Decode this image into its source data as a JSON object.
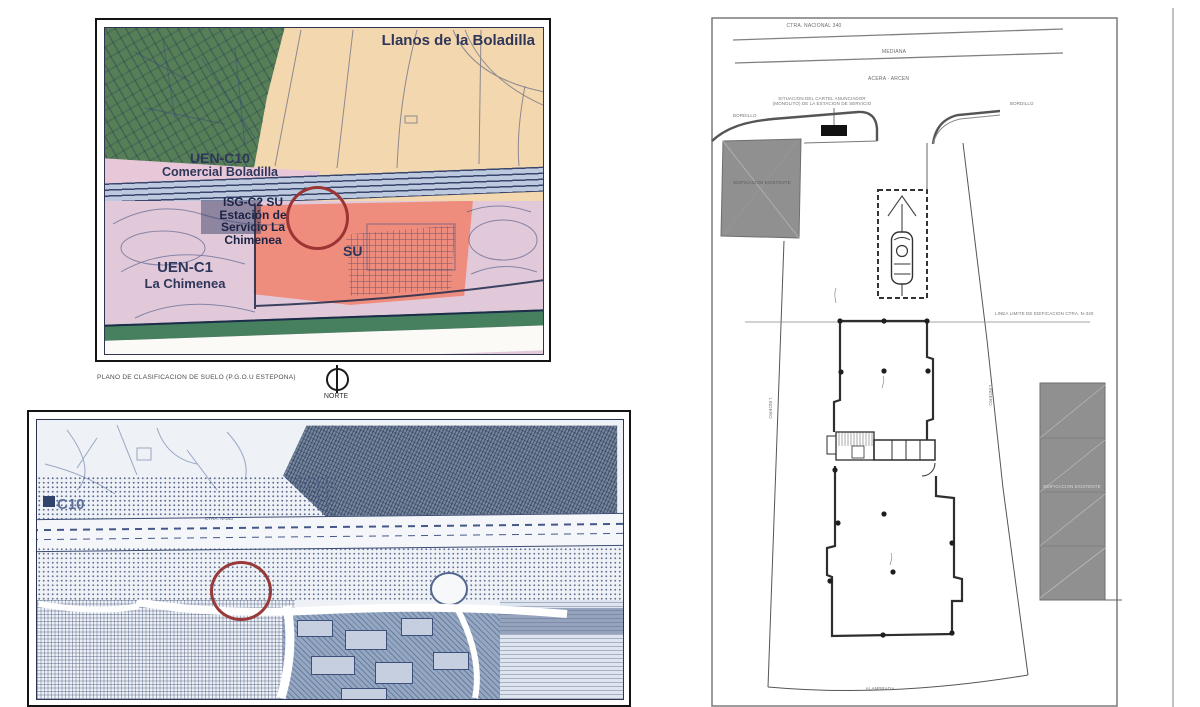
{
  "zoning_map": {
    "region_labels": {
      "area_top": "Llanos de la Boladilla",
      "sector1_code": "UEN-C10",
      "sector1_name": "Comercial Boladilla",
      "site_code": "ISG-C2 SU",
      "site_name_l1": "Estación de",
      "site_name_l2": "Servicio La",
      "site_name_l3": "Chimenea",
      "zone_su": "SU",
      "sector2_code": "UEN-C1",
      "sector2_name": "La Chimenea"
    },
    "caption": "PLANO DE CLASIFICACION DE SUELO (P.G.O.U ESTEPONA)",
    "north_label": "NORTE",
    "colors": {
      "rural_land": "#f3d7ae",
      "green_land": "#567f58",
      "urban_su": "#ee8d7d",
      "urbanizable": "#e2c9da",
      "commercial_strip": "#e8c7d8",
      "road_band": "#bcc9df",
      "highlight_circle": "#9c3434",
      "label_ink": "#2e365a"
    }
  },
  "cadastral_map": {
    "labels": {
      "sector_code": "C10",
      "road": "CTRA. N-340"
    },
    "colors": {
      "paper": "#eef1f6",
      "ink": "#51689a",
      "highlight_circle": "#993a3a"
    }
  },
  "site_plan": {
    "labels": {
      "road_name": "CTRA. NACIONAL 340",
      "median": "MEDIANA",
      "shoulder": "ACERA - ARCEN",
      "sign_note_l1": "SITUACION DEL CARTEL ANUNCIADOR",
      "sign_note_l2": "(MONOLITO) DE LA ESTACION DE SERVICIO",
      "curb_left": "BORDILLO",
      "curb_right": "BORDILLO",
      "build_line": "LINEA LIMITE DE EDIFICACION CTRA. N-340",
      "boundary_left": "LINDERO",
      "boundary_right": "LINDERO",
      "existing_bldg_left": "EDIFICACION EXISTENTE",
      "existing_bldg_right": "EDIFICACION EXISTENTE",
      "fence": "ALAMBRADA"
    }
  }
}
